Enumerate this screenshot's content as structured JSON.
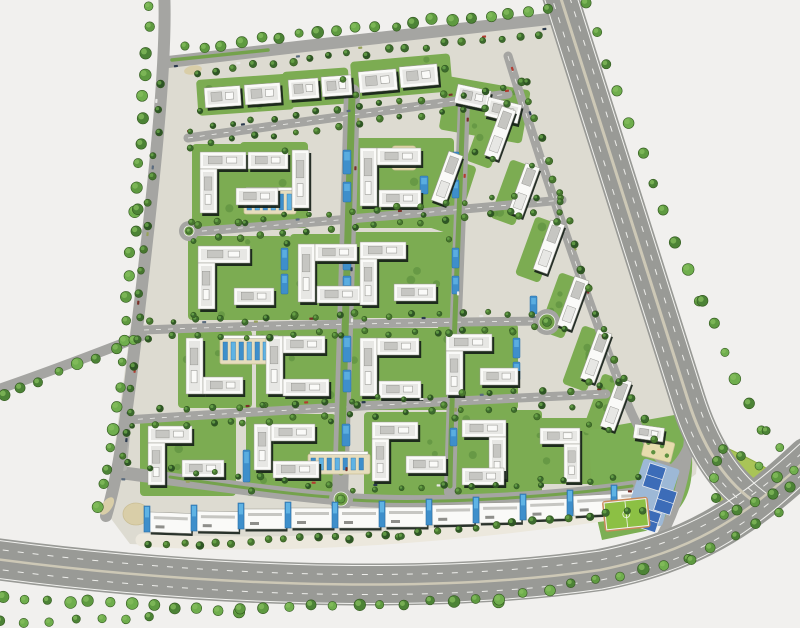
{
  "meta": {
    "title": "residential-community-master-plan",
    "canvas": {
      "w": 800,
      "h": 628
    }
  },
  "palette": {
    "bg": "#F1F0EE",
    "site": "#DDDBD1",
    "roadMajor": "#999A96",
    "roadMinor": "#A5A5A2",
    "roadService": "#B2B2AE",
    "roadEdge": "#F2F2EF",
    "laneDash": "#EDEDEA",
    "medianTan": "#CDC8B6",
    "medianGreen": "#74A24C",
    "islandTan": "#D9CEA8",
    "treeFill": [
      "#4C8336",
      "#5E9A40",
      "#6FAE4D"
    ],
    "treeStroke": "#33591F",
    "treeHi": "#86BE5E",
    "hedge": [
      "#2E5526",
      "#3C6A2E",
      "#47762F"
    ],
    "pad": "#7CAC52",
    "padDot": "#5E9140",
    "lawn": "#7CAF54",
    "bldg": "#FAFAF8",
    "bldgStroke": "#97978F",
    "bldgShadow": "#151F18",
    "roof1": "#E7E7E4",
    "roof2": "#C6C6C2",
    "roof3": "#8F8F8B",
    "pool": "#3E8FCB",
    "poolLight": "#5FB3E4",
    "poolStroke": "#2A6EA5",
    "deck": "#E6DDBE",
    "deckStroke": "#CBBF96",
    "court": "#3C6CB8",
    "courtPad": "#9DB8D6",
    "pitch": "#8CC044",
    "parkFill": "#A9C457",
    "plaza": "#ECE8DD",
    "garden": "#E6DCAD"
  },
  "sitePolygon": "166,62 552,20 700,432 696,474 664,498 600,516 430,538 240,548 130,544 106,512",
  "majorRoads": [
    {
      "name": "bottom-highway",
      "d": "M -12,558 C 180,584 420,596 600,570 C 690,552 742,520 808,458",
      "w": 42
    },
    {
      "name": "right-highway",
      "d": "M 557,-14 C 588,80 636,240 688,400 C 702,444 722,478 752,500",
      "w": 36
    }
  ],
  "outerRoads": [
    {
      "name": "west-road",
      "d": "M 164,-10 C 168,60 152,200 138,320 C 128,400 122,462 106,516",
      "w": 12
    },
    {
      "name": "top-road",
      "d": "M 168,62 C 300,46 470,28 558,18",
      "w": 12
    },
    {
      "name": "west-branch-road",
      "d": "M -10,392 C 50,372 100,352 142,336",
      "w": 10
    }
  ],
  "roadLines": [
    {
      "d": "M -12,539 C 180,565 420,577 600,551 C 688,533 738,502 802,442",
      "w": 1,
      "c": "edge"
    },
    {
      "d": "M -12,577 C 180,603 420,615 602,589 C 694,571 748,538 814,474",
      "w": 1,
      "c": "edge"
    },
    {
      "d": "M -12,548 C 180,574 420,586 600,560 C 689,542 740,511 805,450",
      "w": 1,
      "c": "dash",
      "da": "6 9"
    },
    {
      "d": "M -12,568 C 180,594 420,606 601,580 C 692,562 745,529 811,466",
      "w": 1,
      "c": "dash",
      "da": "6 9"
    },
    {
      "d": "M -12,558 C 180,584 420,596 600,570 C 690,552 742,520 808,458",
      "w": 2.5,
      "c": "median"
    },
    {
      "d": "M 542,-9 C 573,85 621,245 673,405 C 687,449 706,482 734,505",
      "w": 1,
      "c": "edge"
    },
    {
      "d": "M 572,-19 C 603,75 651,235 703,395 C 717,439 737,472 766,493",
      "w": 1,
      "c": "edge"
    },
    {
      "d": "M 549,-11 C 580,82 628,242 680,402 C 694,446 714,479 742,502",
      "w": 1,
      "c": "dash",
      "da": "6 9"
    },
    {
      "d": "M 565,-17 C 596,77 644,237 696,397 C 710,441 729,474 758,496",
      "w": 1,
      "c": "dash",
      "da": "6 9"
    },
    {
      "d": "M 557,-14 C 588,80 636,240 688,400 C 702,444 722,478 752,500",
      "w": 3,
      "c": "median"
    }
  ],
  "minorRoads": [
    {
      "name": "street-1",
      "d": "M 188,138 C 300,122 430,104 508,94",
      "w": 9
    },
    {
      "name": "street-2",
      "d": "M 190,232 C 320,222 480,208 562,200",
      "w": 9
    },
    {
      "name": "street-3",
      "d": "M 144,330 C 300,324 470,322 538,321",
      "w": 9
    },
    {
      "name": "street-4",
      "d": "M 126,420 C 280,410 470,400 606,394",
      "w": 9
    },
    {
      "name": "south-boulevard",
      "d": "M 116,472 C 240,488 300,496 341,499 C 430,506 560,498 640,486 C 672,480 688,460 694,434",
      "w": 13
    },
    {
      "name": "east-collector",
      "d": "M 508,56 C 540,160 580,280 622,390 C 636,428 652,452 670,470",
      "w": 9
    },
    {
      "name": "central-boulevard",
      "d": "M 352,92 C 348,260 344,380 340,498",
      "w": 16
    },
    {
      "name": "east-vertical-street",
      "d": "M 464,100 C 458,280 452,400 450,492",
      "w": 12
    },
    {
      "name": "east-access-road",
      "d": "M 690,424 C 688,468 678,508 658,542",
      "w": 10
    },
    {
      "name": "west-service-lane",
      "d": "M 160,78 C 150,200 136,330 124,468",
      "w": 6
    }
  ],
  "minorDashes": [
    "M 188,138 C 300,122 430,104 508,94",
    "M 190,232 C 320,222 480,208 562,200",
    "M 144,330 C 300,324 470,322 538,321",
    "M 126,420 C 280,410 470,400 606,394",
    "M 508,56 C 540,160 580,280 622,390"
  ],
  "medianStrips": [
    {
      "d": "M 352,96 C 348,260 344,380 341,472",
      "w": 7
    },
    {
      "d": "M 463,104 C 457,280 451,400 450,486",
      "w": 5
    },
    {
      "d": "M 172,60 C 210,56 240,53 268,50",
      "w": 3.5
    },
    {
      "d": "M 170,477 C 250,489 300,495 330,497",
      "w": 3
    },
    {
      "d": "M 352,500 C 440,505 560,496 632,486",
      "w": 3
    }
  ],
  "islands": [
    {
      "cx": 193,
      "cy": 70,
      "rx": 9,
      "ry": 4.5,
      "rot": -10
    },
    {
      "cx": 107,
      "cy": 506,
      "rx": 10,
      "ry": 5,
      "rot": -55
    }
  ],
  "roundabouts": [
    [
      189,
      231,
      7
    ],
    [
      547,
      322,
      10
    ],
    [
      341,
      499,
      9
    ]
  ],
  "treeLines": [
    [
      184,
      48,
      548,
      8,
      20,
      4,
      6,
      0
    ],
    [
      150,
      6,
      136,
      210,
      10,
      4,
      6,
      0
    ],
    [
      136,
      210,
      114,
      430,
      11,
      4,
      6,
      0
    ],
    [
      114,
      430,
      100,
      505,
      5,
      4,
      6,
      0
    ],
    [
      2,
      396,
      136,
      342,
      8,
      4,
      6,
      0
    ],
    [
      584,
      4,
      700,
      300,
      11,
      4,
      6,
      0
    ],
    [
      700,
      300,
      762,
      428,
      6,
      4,
      6,
      0
    ],
    [
      764,
      432,
      794,
      468,
      3,
      4,
      5,
      0
    ],
    [
      4,
      598,
      240,
      610,
      12,
      4,
      6,
      0
    ],
    [
      240,
      610,
      500,
      600,
      12,
      4,
      6,
      0
    ],
    [
      500,
      600,
      690,
      560,
      9,
      4,
      6,
      0
    ],
    [
      690,
      560,
      778,
      512,
      5,
      4,
      5,
      0
    ],
    [
      0,
      622,
      150,
      619,
      7,
      4,
      5,
      0
    ],
    [
      150,
      545,
      400,
      536,
      16,
      3,
      4,
      1
    ],
    [
      400,
      536,
      645,
      510,
      14,
      3,
      4,
      1
    ],
    [
      162,
      84,
      124,
      458,
      17,
      3,
      4,
      1
    ],
    [
      196,
      72,
      540,
      34,
      19,
      3,
      4,
      1
    ],
    [
      520,
      80,
      560,
      200,
      7,
      3,
      4,
      1
    ],
    [
      560,
      200,
      620,
      380,
      9,
      3,
      4,
      1
    ],
    [
      620,
      380,
      656,
      438,
      4,
      3,
      4,
      1
    ],
    [
      190,
      130,
      505,
      88,
      16,
      2.5,
      3.5,
      1
    ],
    [
      192,
      146,
      506,
      104,
      16,
      2.5,
      3.5,
      1
    ],
    [
      194,
      224,
      558,
      194,
      17,
      2.5,
      3.5,
      1
    ],
    [
      194,
      240,
      558,
      210,
      17,
      2.5,
      3.5,
      1
    ],
    [
      148,
      322,
      534,
      313,
      17,
      2.5,
      3.5,
      1
    ],
    [
      148,
      338,
      534,
      329,
      17,
      2.5,
      3.5,
      1
    ],
    [
      130,
      412,
      598,
      388,
      18,
      2.5,
      3.5,
      1
    ],
    [
      130,
      428,
      598,
      404,
      18,
      2.5,
      3.5,
      1
    ],
    [
      126,
      464,
      330,
      486,
      10,
      2.5,
      3.5,
      1
    ],
    [
      352,
      492,
      636,
      478,
      13,
      2.5,
      3.5,
      1
    ]
  ],
  "pads": [
    [
      196,
      80,
      96,
      36,
      -4
    ],
    [
      282,
      72,
      66,
      36,
      -4
    ],
    [
      350,
      62,
      100,
      38,
      -5
    ],
    [
      448,
      76,
      84,
      54,
      10
    ],
    [
      192,
      144,
      98,
      86,
      0
    ],
    [
      240,
      142,
      68,
      86,
      0
    ],
    [
      350,
      138,
      104,
      90,
      0
    ],
    [
      418,
      148,
      62,
      72,
      18
    ],
    [
      188,
      236,
      104,
      84,
      0
    ],
    [
      290,
      234,
      74,
      86,
      0
    ],
    [
      350,
      232,
      104,
      86,
      0
    ],
    [
      178,
      330,
      74,
      78,
      0
    ],
    [
      256,
      328,
      84,
      82,
      0
    ],
    [
      350,
      328,
      104,
      82,
      0
    ],
    [
      438,
      324,
      80,
      86,
      0
    ],
    [
      140,
      416,
      96,
      80,
      0
    ],
    [
      246,
      414,
      90,
      82,
      0
    ],
    [
      364,
      412,
      96,
      86,
      0
    ],
    [
      454,
      410,
      88,
      86,
      0
    ],
    [
      534,
      418,
      60,
      66,
      0
    ],
    [
      487,
      102,
      26,
      62,
      20
    ],
    [
      511,
      159,
      26,
      62,
      20
    ],
    [
      536,
      216,
      26,
      62,
      20
    ],
    [
      560,
      272,
      26,
      62,
      20
    ],
    [
      583,
      325,
      26,
      62,
      20
    ],
    [
      603,
      373,
      26,
      62,
      20
    ]
  ],
  "bars": [
    [
      204,
      88,
      36,
      20,
      -4
    ],
    [
      244,
      85,
      36,
      20,
      -4
    ],
    [
      288,
      80,
      30,
      20,
      -4
    ],
    [
      321,
      77,
      30,
      20,
      -4
    ],
    [
      358,
      72,
      38,
      21,
      -5
    ],
    [
      399,
      67,
      38,
      21,
      -5
    ],
    [
      458,
      84,
      34,
      19,
      12
    ],
    [
      489,
      97,
      34,
      19,
      14
    ],
    [
      200,
      152,
      46,
      17,
      0
    ],
    [
      200,
      169,
      17,
      44,
      0
    ],
    [
      236,
      188,
      42,
      17,
      0
    ],
    [
      248,
      152,
      40,
      17,
      0
    ],
    [
      292,
      150,
      17,
      58,
      0
    ],
    [
      360,
      148,
      17,
      58,
      0
    ],
    [
      377,
      148,
      44,
      17,
      0
    ],
    [
      379,
      190,
      42,
      17,
      0
    ],
    [
      198,
      246,
      52,
      17,
      0
    ],
    [
      198,
      263,
      17,
      46,
      0
    ],
    [
      234,
      288,
      40,
      17,
      0
    ],
    [
      298,
      244,
      17,
      58,
      0
    ],
    [
      315,
      244,
      42,
      17,
      0
    ],
    [
      317,
      286,
      44,
      17,
      0
    ],
    [
      360,
      242,
      46,
      17,
      0
    ],
    [
      360,
      259,
      17,
      46,
      0
    ],
    [
      394,
      284,
      42,
      17,
      0
    ],
    [
      186,
      338,
      17,
      56,
      0
    ],
    [
      203,
      377,
      40,
      17,
      0
    ],
    [
      266,
      336,
      17,
      58,
      0
    ],
    [
      283,
      336,
      42,
      17,
      0
    ],
    [
      283,
      379,
      46,
      17,
      0
    ],
    [
      360,
      338,
      17,
      58,
      0
    ],
    [
      377,
      338,
      42,
      17,
      0
    ],
    [
      379,
      381,
      42,
      17,
      0
    ],
    [
      446,
      334,
      46,
      17,
      0
    ],
    [
      446,
      351,
      17,
      44,
      0
    ],
    [
      480,
      368,
      38,
      17,
      0
    ],
    [
      148,
      426,
      44,
      17,
      0
    ],
    [
      148,
      443,
      17,
      42,
      0
    ],
    [
      182,
      460,
      42,
      17,
      0
    ],
    [
      254,
      424,
      17,
      46,
      0
    ],
    [
      271,
      424,
      44,
      17,
      0
    ],
    [
      273,
      461,
      46,
      17,
      0
    ],
    [
      372,
      422,
      46,
      17,
      0
    ],
    [
      372,
      439,
      17,
      42,
      0
    ],
    [
      406,
      456,
      40,
      17,
      0
    ],
    [
      462,
      420,
      44,
      17,
      0
    ],
    [
      489,
      437,
      17,
      42,
      0
    ],
    [
      462,
      468,
      42,
      17,
      0
    ],
    [
      540,
      428,
      40,
      16,
      0
    ],
    [
      564,
      444,
      16,
      38,
      0
    ],
    [
      635,
      424,
      30,
      14,
      8
    ]
  ],
  "slabs": [
    [
      447,
      178,
      20
    ],
    [
      500,
      133,
      20
    ],
    [
      524,
      190,
      20
    ],
    [
      549,
      247,
      20
    ],
    [
      573,
      303,
      20
    ],
    [
      596,
      356,
      20
    ],
    [
      616,
      404,
      20
    ]
  ],
  "slabSize": {
    "w": 15,
    "l": 52
  },
  "pools": [
    [
      343,
      150,
      8,
      24
    ],
    [
      343,
      182,
      8,
      20
    ],
    [
      343,
      246,
      8,
      24
    ],
    [
      343,
      276,
      8,
      20
    ],
    [
      343,
      336,
      8,
      26
    ],
    [
      343,
      370,
      8,
      22
    ],
    [
      342,
      424,
      8,
      22
    ],
    [
      452,
      152,
      7,
      20
    ],
    [
      452,
      180,
      7,
      18
    ],
    [
      452,
      248,
      7,
      20
    ],
    [
      452,
      276,
      7,
      18
    ],
    [
      451,
      340,
      7,
      20
    ],
    [
      451,
      366,
      7,
      18
    ],
    [
      450,
      428,
      7,
      18
    ],
    [
      281,
      248,
      7,
      22
    ],
    [
      281,
      274,
      7,
      20
    ],
    [
      243,
      450,
      7,
      32
    ],
    [
      513,
      338,
      7,
      20
    ],
    [
      513,
      362,
      7,
      18
    ],
    [
      420,
      176,
      8,
      18
    ],
    [
      530,
      296,
      7,
      18
    ]
  ],
  "poolCourts": [
    [
      244,
      190,
      52,
      24
    ],
    [
      220,
      338,
      60,
      26
    ],
    [
      308,
      454,
      62,
      20
    ]
  ],
  "palmPlaza": {
    "x": 392,
    "y": 146,
    "w": 24,
    "h": 24
  },
  "commercial": {
    "slabW": 42,
    "slabH": 20,
    "divW": 6,
    "divH": 26,
    "slabs": [
      [
        150,
        512,
        2
      ],
      [
        197,
        511,
        1
      ],
      [
        244,
        509,
        0
      ],
      [
        291,
        508,
        0
      ],
      [
        338,
        508,
        0
      ],
      [
        385,
        507,
        0
      ],
      [
        432,
        505,
        -1
      ],
      [
        479,
        503,
        -1
      ],
      [
        526,
        500,
        -2
      ],
      [
        573,
        496,
        -3
      ],
      [
        617,
        491,
        -3
      ]
    ],
    "dividers": [
      [
        144,
        509
      ],
      [
        191,
        508
      ],
      [
        238,
        506
      ],
      [
        285,
        505
      ],
      [
        332,
        505
      ],
      [
        379,
        504
      ],
      [
        426,
        502
      ],
      [
        473,
        500
      ],
      [
        520,
        497
      ],
      [
        567,
        493
      ],
      [
        611,
        488
      ]
    ],
    "plazaPath": "M 142,540 C 300,550 480,534 650,508",
    "plazaW": 13,
    "entry": {
      "cx": 136,
      "cy": 514,
      "rx": 13,
      "ry": 11
    }
  },
  "amenities": {
    "lawn": "M 590,430 L 680,414 Q 696,444 691,480 Q 686,514 650,530 L 602,540 Q 588,486 590,430 Z",
    "garden": {
      "x": 646,
      "y": 436,
      "w": 30,
      "h": 20,
      "rot": 14
    },
    "courtPad": {
      "x": 644,
      "y": 458,
      "w": 38,
      "h": 60,
      "rot": 18
    },
    "courts": [
      [
        650,
        463,
        17,
        24,
        18
      ],
      [
        661,
        487,
        17,
        24,
        18
      ],
      [
        647,
        509,
        15,
        20,
        18
      ]
    ],
    "pitch": {
      "x": 604,
      "y": 503,
      "w": 42,
      "h": 27,
      "rot": -6
    },
    "park": "M 722,446 Q 760,462 794,486 Q 758,504 724,518 Q 713,482 722,446 Z",
    "parkTrees": [
      [
        723,
        449
      ],
      [
        741,
        456
      ],
      [
        759,
        466
      ],
      [
        777,
        477
      ],
      [
        790,
        487
      ],
      [
        773,
        494
      ],
      [
        755,
        502
      ],
      [
        737,
        510
      ],
      [
        724,
        515
      ],
      [
        716,
        498
      ],
      [
        714,
        478
      ],
      [
        717,
        461
      ]
    ]
  },
  "cars": {
    "colors": [
      "#B23B30",
      "#2B3A4E",
      "#E8E8E6",
      "#5A6B7E",
      "#97A25A",
      "#7A2F28"
    ],
    "lines": [
      [
        190,
        131,
        505,
        89,
        7
      ],
      [
        193,
        227,
        557,
        197,
        8
      ],
      [
        147,
        324,
        535,
        316,
        8
      ],
      [
        129,
        413,
        600,
        390,
        9
      ],
      [
        357,
        120,
        345,
        470,
        8
      ],
      [
        466,
        118,
        453,
        468,
        7
      ],
      [
        513,
        70,
        620,
        380,
        8
      ],
      [
        176,
        68,
        544,
        28,
        7
      ],
      [
        158,
        100,
        127,
        440,
        6
      ],
      [
        125,
        479,
        628,
        492,
        9
      ]
    ]
  }
}
